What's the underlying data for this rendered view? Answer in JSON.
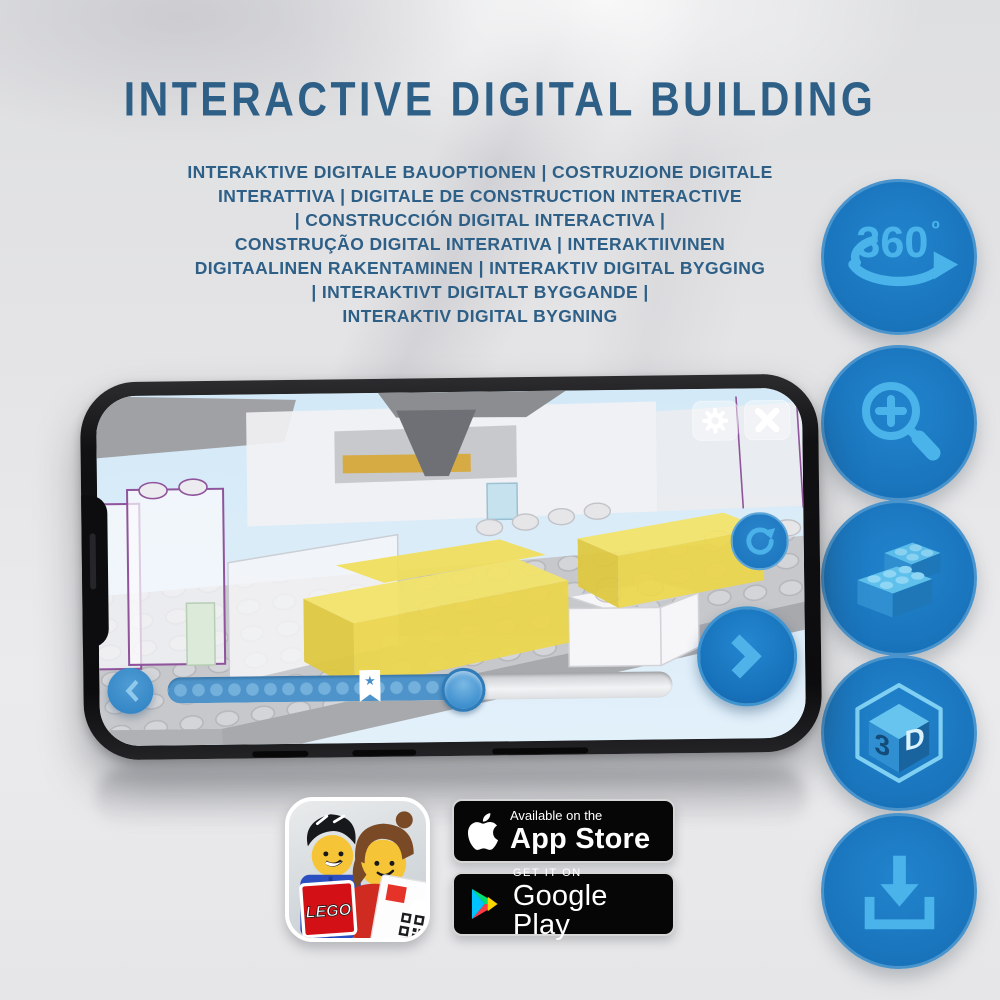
{
  "title": "INTERACTIVE DIGITAL BUILDING",
  "subtitle_lines": [
    "INTERAKTIVE DIGITALE BAUOPTIONEN | COSTRUZIONE DIGITALE",
    "INTERATTIVA | DIGITALE DE CONSTRUCTION INTERACTIVE",
    "| CONSTRUCCIÓN DIGITAL INTERACTIVA |",
    "CONSTRUÇÃO DIGITAL INTERATIVA | INTERAKTIIVINEN",
    "DIGITAALINEN RAKENTAMINEN | INTERAKTIV DIGITAL BYGGING",
    "| INTERAKTIVT DIGITALT BYGGANDE |",
    "INTERAKTIV DIGITAL BYGNING"
  ],
  "feature_icons": {
    "rotate360": {
      "label": "360",
      "degree": "º"
    },
    "threed": {
      "digit": "3",
      "letter": "D"
    }
  },
  "phone_app": {
    "progress_percent": 58,
    "bookmark_percent": 40,
    "bookmark_star": "★"
  },
  "store_badges": {
    "app_store": {
      "tagline": "Available on the",
      "name": "App Store"
    },
    "google_play": {
      "tagline": "GET IT ON",
      "name": "Google Play"
    }
  },
  "lego_app_icon": {
    "logo_text": "LEGO"
  },
  "colors": {
    "title_blue": "#2d5f87",
    "circle_blue": "#1b78c0",
    "icon_light_blue": "#49b3ea",
    "screen_sky": "#d8ebf7",
    "brick_yellow": "#f2e15e",
    "outline_purple": "#8f549c"
  }
}
